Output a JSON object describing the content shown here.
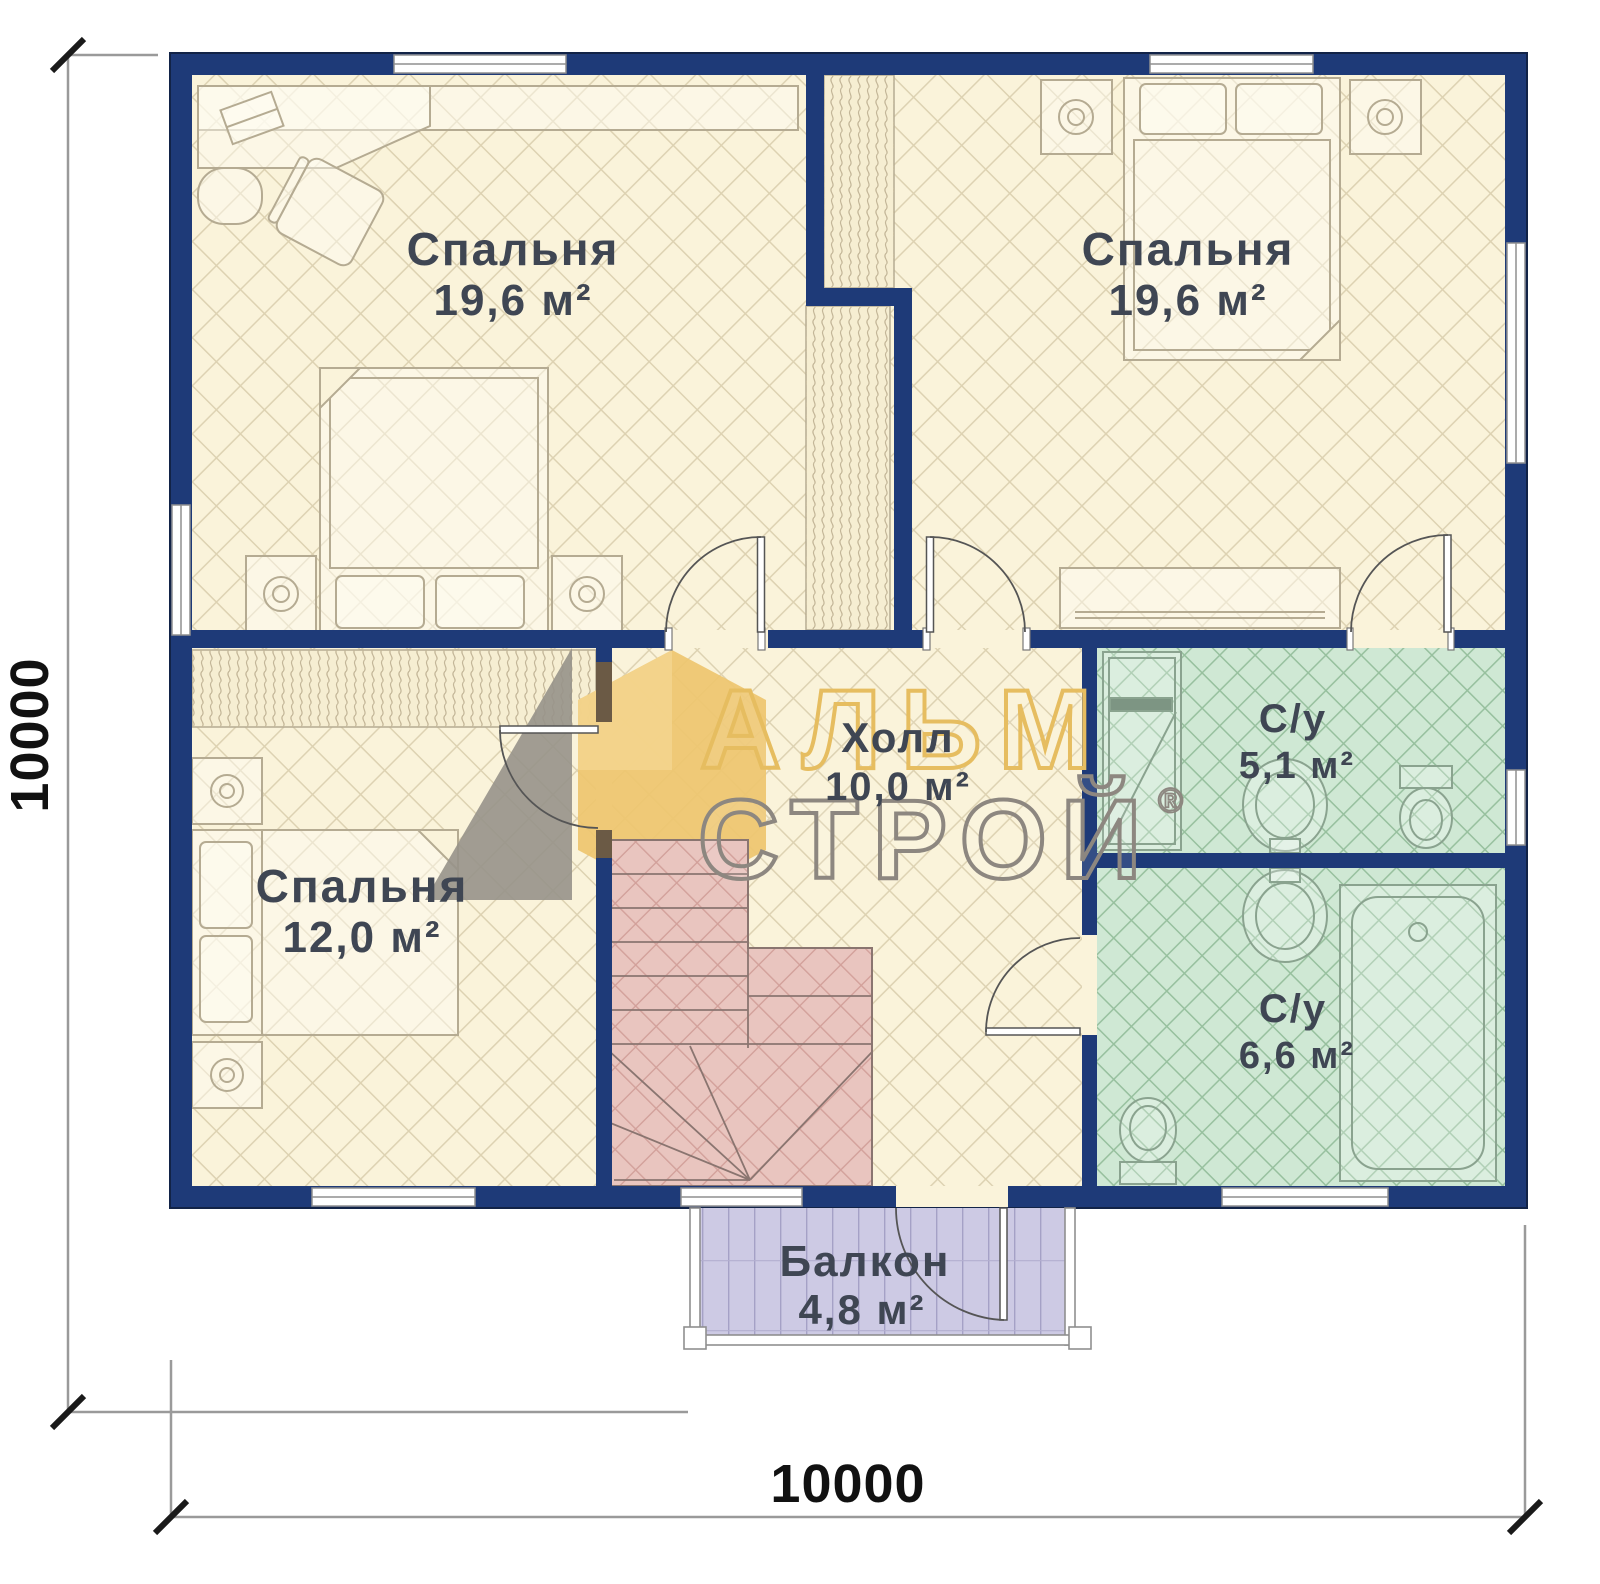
{
  "plan": {
    "dimension_width": "10000",
    "dimension_height": "10000",
    "rooms": [
      {
        "name": "Спальня",
        "area": "19,6 м²"
      },
      {
        "name": "Спальня",
        "area": "19,6 м²"
      },
      {
        "name": "Спальня",
        "area": "12,0 м²"
      },
      {
        "name": "Холл",
        "area": "10,0 м²"
      },
      {
        "name": "С/у",
        "area": "5,1 м²"
      },
      {
        "name": "С/у",
        "area": "6,6 м²"
      },
      {
        "name": "Балкон",
        "area": "4,8 м²"
      }
    ],
    "watermark": {
      "word1": "АЛЬМ",
      "word2": "СТРОЙ",
      "reg": "®"
    },
    "colors": {
      "wall_navy": "#1e3a78",
      "floor_cream": "#faf3da",
      "floor_green": "#cfe8d4",
      "stairs_pink": "#e9c5bf",
      "balcony_lavender": "#cdcae4",
      "label_text": "#3f4653",
      "watermark_yellow": "#e6bd60",
      "watermark_gray": "#8d8780"
    }
  }
}
